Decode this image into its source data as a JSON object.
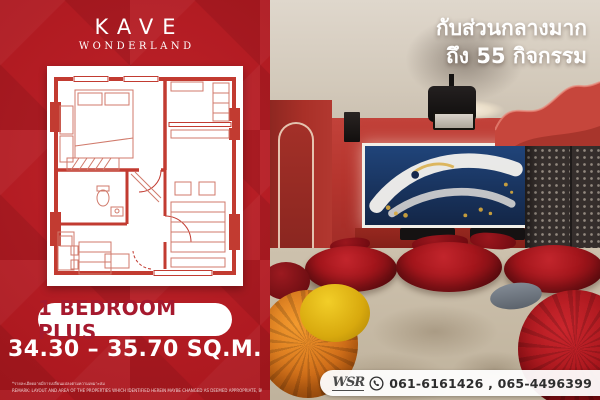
{
  "brand": {
    "name": "KAVE",
    "subtitle": "WONDERLAND"
  },
  "left_panel": {
    "unit_type": "1 BEDROOM PLUS",
    "area_range": "34.30 – 35.70 SQ.M.",
    "disclaimer_th": "*รายละเอียดอาจมีการเปลี่ยนแปลงตามความเหมาะสม",
    "disclaimer_en": "REMARK: LAYOUT AND AREA OF THE PROPERTIES WHICH IDENTIFIED HEREIN MAYBE CHANGED AS DEEMED APPROPRIATE, BUT WILL NOT IMPACT UPON THE USE."
  },
  "photo": {
    "headline_line1": "กับส่วนกลางมาก",
    "headline_line2": "ถึง 55 กิจกรรม"
  },
  "contact": {
    "logo_text": "WSR",
    "phones": "061-6161426 , 065-4496399"
  },
  "colors": {
    "brand_red": "#AF1D24",
    "pill_text_red": "#A6192E",
    "photo_wall_red": "#B93B33",
    "carpet_beige": "#C7BAA5",
    "screen_blue": "#1C3A6E",
    "gold_accent": "#D8A93C"
  }
}
